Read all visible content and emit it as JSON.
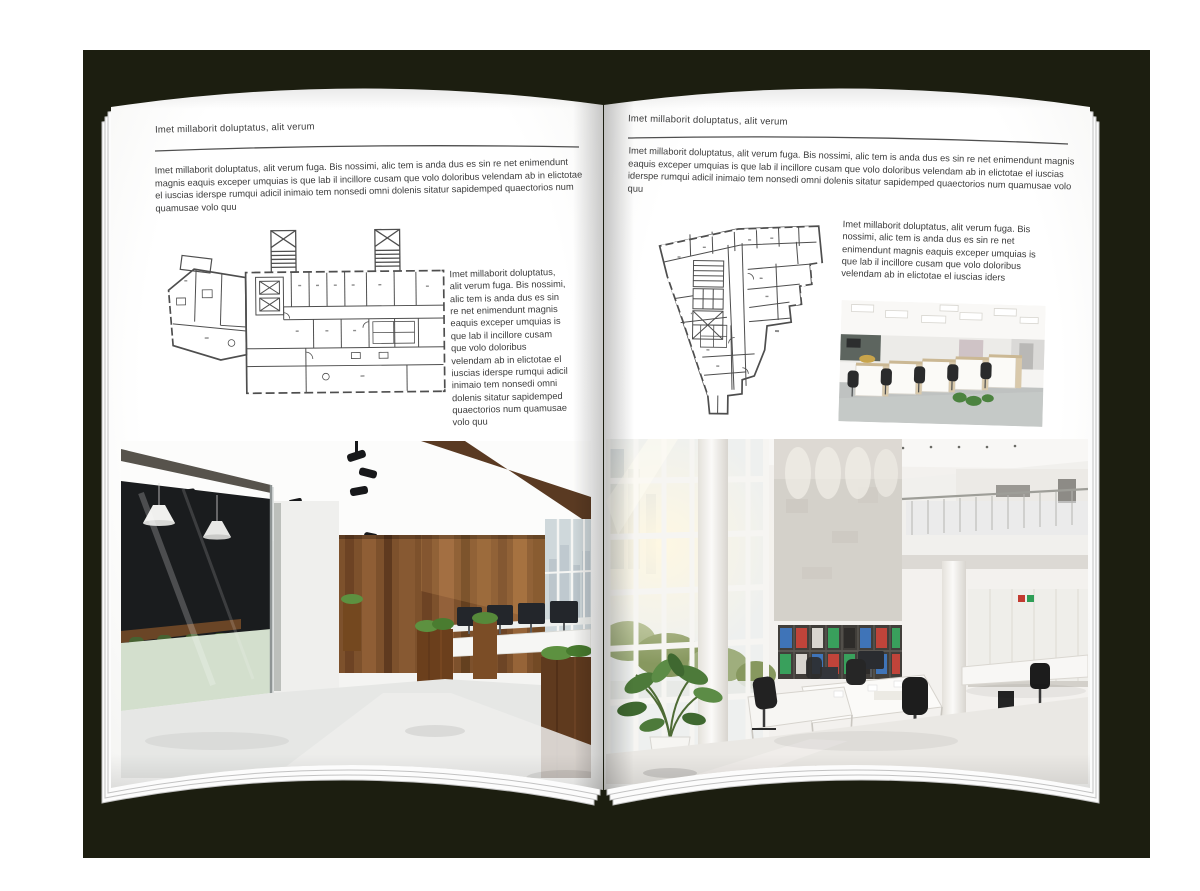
{
  "colors": {
    "canvas": "#ffffff",
    "backdrop": "#1c1e10",
    "paper": "#ffffff",
    "ink": "#3b3b3b",
    "rule_line": "#4f4f4f",
    "plan_line": "#4e4e4e",
    "wood_wall": "#7d512c",
    "meeting_room_chair_green": "#466231",
    "binder_red": "#c0443a",
    "binder_green": "#39a05c",
    "binder_blue": "#3f74b8"
  },
  "left_page": {
    "header": "Imet millaborit doluptatus, alit verum",
    "intro": "Imet millaborit doluptatus, alit verum fuga. Bis nossimi, alic tem is anda dus es sin re net enimendunt magnis eaquis exceper umquias is que lab il incillore cusam que volo doloribus velendam ab in elictotae el iuscias iderspe rumqui adicil inimaio tem nonsedi omni dolenis sitatur sapidemped quaectorios num quamusae volo quu",
    "plan_caption": "Imet millaborit doluptatus, alit verum fuga. Bis nossimi, alic tem is anda dus es sin re net enimendunt magnis eaquis exceper umquias is que lab il incillore cusam que volo doloribus velendam ab in elictotae el iuscias iderspe rumqui adicil inimaio tem nonsedi omni dolenis sitatur sapidemped quaectorios num quamusae volo quu"
  },
  "right_page": {
    "header": "Imet millaborit doluptatus, alit verum",
    "intro": "Imet millaborit doluptatus, alit verum fuga. Bis nossimi, alic tem is anda dus es sin re net enimendunt magnis eaquis exceper umquias is que lab il incillore cusam que volo doloribus velendam ab in elictotae el iuscias iderspe rumqui adicil inimaio tem nonsedi omni dolenis sitatur sapidemped quaectorios num quamusae volo quu",
    "plan_caption": "Imet millaborit doluptatus, alit verum fuga. Bis nossimi, alic tem is anda dus es sin re net enimendunt magnis eaquis exceper umquias is que lab il incillore cusam que volo doloribus velendam ab in elictotae el iuscias iders"
  }
}
